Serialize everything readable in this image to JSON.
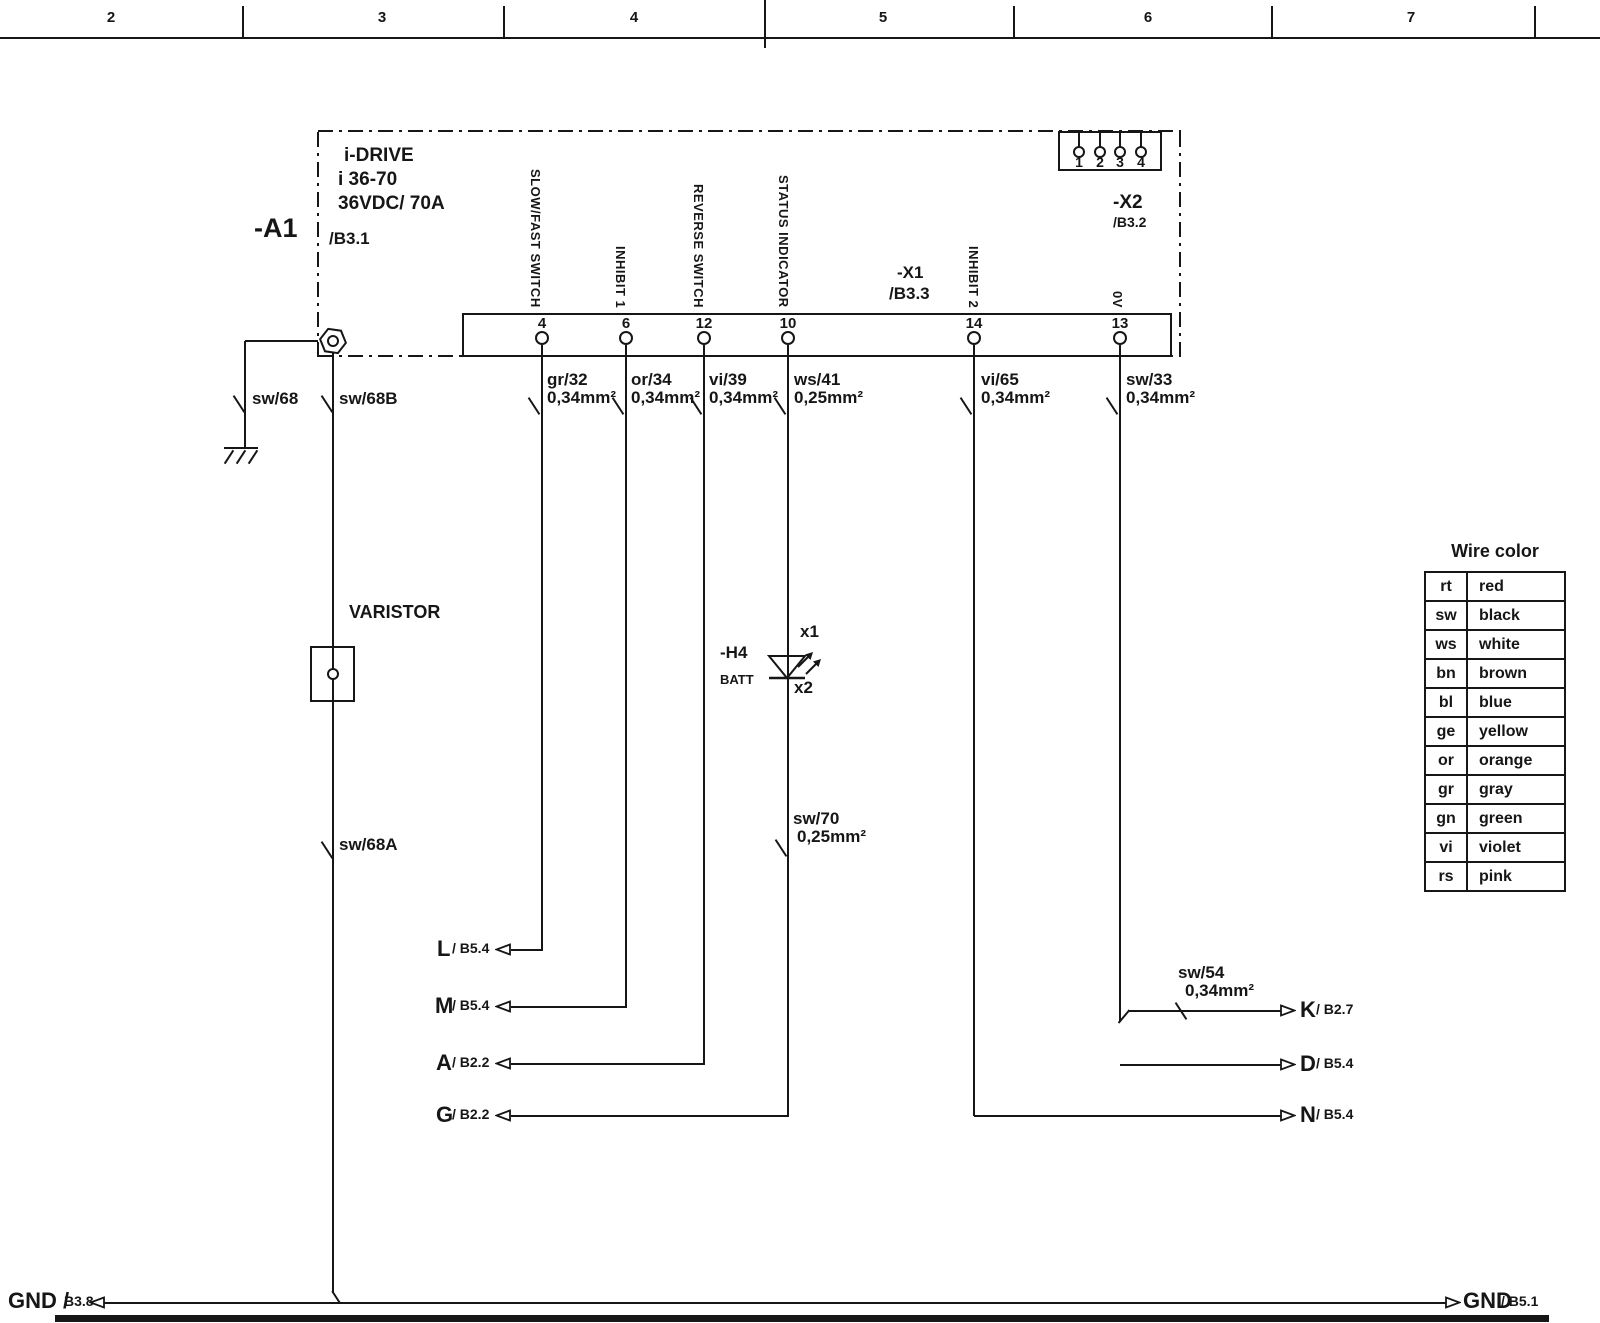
{
  "ruler": {
    "numbers": [
      "2",
      "3",
      "4",
      "5",
      "6",
      "7"
    ]
  },
  "device": {
    "ref": "-A1",
    "title": "i-DRIVE",
    "model": "i 36-70",
    "rating": "36VDC/ 70A",
    "sheet": "/B3.1"
  },
  "x1": {
    "ref": "-X1",
    "sheet": "/B3.3",
    "pins": [
      {
        "num": "4",
        "fn": "SLOW/FAST SWITCH"
      },
      {
        "num": "6",
        "fn": "INHIBIT 1"
      },
      {
        "num": "12",
        "fn": "REVERSE SWITCH"
      },
      {
        "num": "10",
        "fn": "STATUS INDICATOR"
      },
      {
        "num": "14",
        "fn": "INHIBIT 2"
      },
      {
        "num": "13",
        "fn": "0V"
      }
    ]
  },
  "x2": {
    "ref": "-X2",
    "sheet": "/B3.2",
    "pins": [
      "1",
      "2",
      "3",
      "4"
    ]
  },
  "wires": {
    "sw68": {
      "name": "sw/68"
    },
    "sw68b": {
      "name": "sw/68B"
    },
    "sw68a": {
      "name": "sw/68A"
    },
    "gr32": {
      "name": "gr/32",
      "size": "0,34mm²"
    },
    "or34": {
      "name": "or/34",
      "size": "0,34mm²"
    },
    "vi39": {
      "name": "vi/39",
      "size": "0,34mm²"
    },
    "ws41": {
      "name": "ws/41",
      "size": "0,25mm²"
    },
    "vi65": {
      "name": "vi/65",
      "size": "0,34mm²"
    },
    "sw33": {
      "name": "sw/33",
      "size": "0,34mm²"
    },
    "sw70": {
      "name": "sw/70",
      "size": "0,25mm²"
    },
    "sw54": {
      "name": "sw/54",
      "size": "0,34mm²"
    }
  },
  "varistor": {
    "label": "VARISTOR"
  },
  "led": {
    "ref": "-H4",
    "name": "BATT",
    "pin_top": "x1",
    "pin_bottom": "x2"
  },
  "dest_left": [
    {
      "letter": "L",
      "sheet": "/ B5.4"
    },
    {
      "letter": "M",
      "sheet": "/ B5.4"
    },
    {
      "letter": "A",
      "sheet": "/ B2.2"
    },
    {
      "letter": "G",
      "sheet": "/ B2.2"
    }
  ],
  "dest_right": [
    {
      "letter": "K",
      "sheet": "/ B2.7"
    },
    {
      "letter": "D",
      "sheet": "/ B5.4"
    },
    {
      "letter": "N",
      "sheet": "/ B5.4"
    }
  ],
  "gnd_left": {
    "label": "GND /",
    "sheet": "B3.8"
  },
  "gnd_right": {
    "label": "GND",
    "sheet": "/ B5.1"
  },
  "color_table": {
    "title": "Wire color",
    "rows": [
      {
        "code": "rt",
        "color": "red"
      },
      {
        "code": "sw",
        "color": "black"
      },
      {
        "code": "ws",
        "color": "white"
      },
      {
        "code": "bn",
        "color": "brown"
      },
      {
        "code": "bl",
        "color": "blue"
      },
      {
        "code": "ge",
        "color": "yellow"
      },
      {
        "code": "or",
        "color": "orange"
      },
      {
        "code": "gr",
        "color": "gray"
      },
      {
        "code": "gn",
        "color": "green"
      },
      {
        "code": "vi",
        "color": "violet"
      },
      {
        "code": "rs",
        "color": "pink"
      }
    ]
  }
}
